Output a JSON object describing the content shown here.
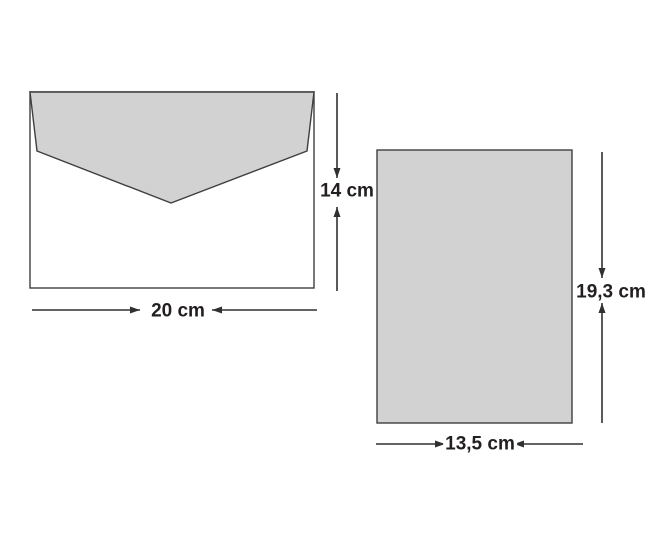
{
  "diagram": {
    "background_color": "#ffffff",
    "shape_fill_color": "#d2d2d2",
    "shape_stroke_color": "#3f3f3f",
    "arrow_color": "#303030",
    "label_text_color": "#231f20",
    "envelope": {
      "width_label": "20 cm",
      "height_label": "14 cm"
    },
    "card": {
      "width_label": "13,5 cm",
      "height_label": "19,3 cm"
    }
  }
}
